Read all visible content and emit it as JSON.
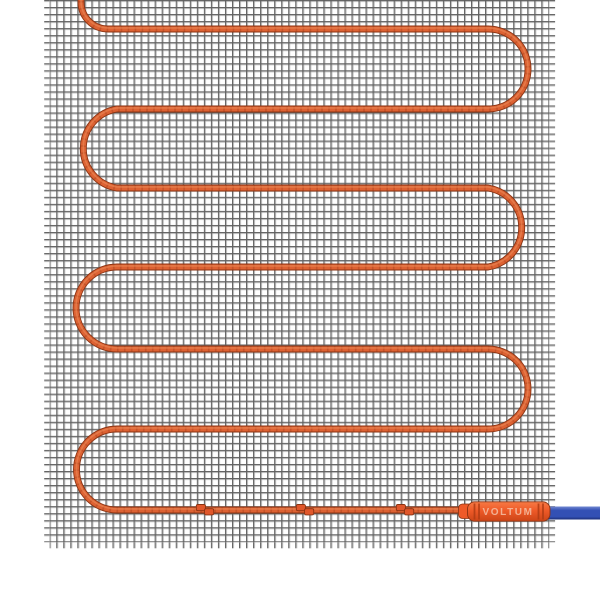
{
  "scene": {
    "description": "Electric underfloor heating mat: white fiberglass mesh grid with orange serpentine heating cable, three splice clips on the bottom run, branded connector sleeve and blue power lead exiting right"
  },
  "connector": {
    "label": "VOLTUM"
  },
  "cable": {
    "path_d": "M 81 -6 V 2 A 27 27 0 0 0 108 29 H 488 A 40 40 0 0 1 488 109 H 117 A 40 40 0 0 0 117 188 H 488 A 40 40 0 0 1 488 267 H 117 A 40 40 0 0 0 117 349 H 488 A 40 40 0 0 1 488 429 H 117 A 40 40 0 0 0 117 510 H 464",
    "texture_dasharray": "1.6 5.4",
    "runs_y": [
      29,
      109,
      188,
      267,
      349,
      429,
      510
    ],
    "left_turn_apex_x": 77,
    "right_turn_apex_x": 528,
    "start_x": 81
  },
  "clips": [
    {
      "transform": "translate(205,510)"
    },
    {
      "transform": "translate(305,510)"
    },
    {
      "transform": "translate(405,510)"
    }
  ],
  "mesh": {
    "left": 49.7,
    "top": 0,
    "width": 499.6,
    "height": 542.3,
    "cell": 7.03
  },
  "colors": {
    "background": "#ffffff",
    "mesh_line": "#606060",
    "mesh_line_light": "#ababab",
    "cable_outline": "#8a3312",
    "cable_main": "#dd6233",
    "cable_texture": "#b04620",
    "cable_highlight": "#eb8a58",
    "clip_fill": "#e0572b",
    "connector_top": "#f77a45",
    "connector_mid": "#ee5a28",
    "connector_bottom": "#cc4517",
    "connector_dark": "#b03c14",
    "connector_text": "#f6c7ae",
    "lead_blue_top": "#7288d2",
    "lead_blue": "#3350b4",
    "lead_blue_dark": "#1c2e77"
  }
}
